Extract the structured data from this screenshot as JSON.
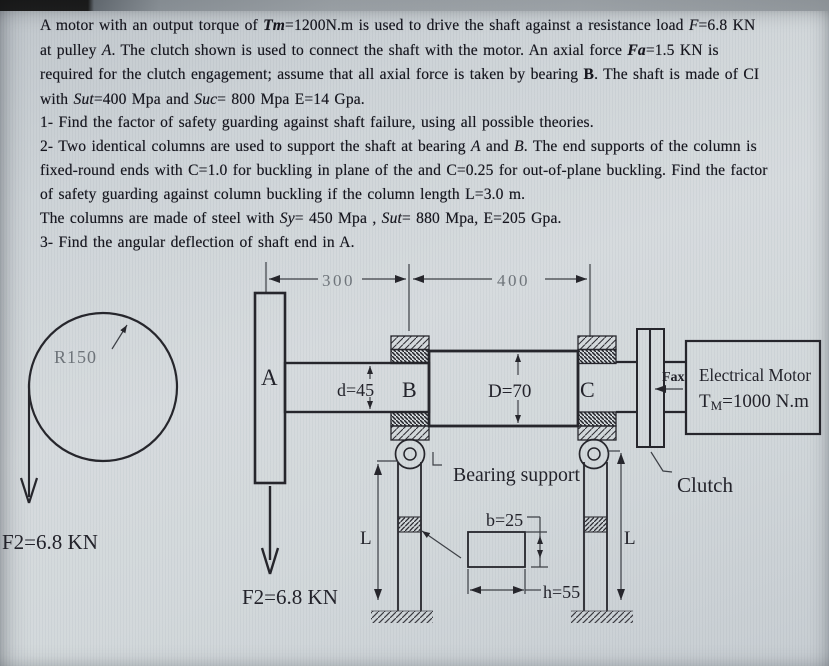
{
  "problem": {
    "para1": [
      "A motor with an output torque of <b><i>Tm</i></b>=1200N.m is used to drive the shaft against a resistance load <i>F</i>=6.8 KN",
      "at pulley <i>A</i>. The clutch shown is used to connect the shaft with the motor. An axial force <b><i>Fa</i></b>=1.5 KN is",
      "required for the clutch engagement; assume that all axial force is taken by bearing <b>B</b>. The shaft is made of CI",
      "with <i>Sut</i>=400 Mpa and <i>Suc</i>= 800 Mpa E=14 Gpa."
    ],
    "para2": [
      "1- Find the factor of safety guarding against shaft failure, using all possible theories.",
      "2- Two identical columns are used to support the shaft at bearing <i>A</i> and <i>B</i>. The end supports of the column is",
      "fixed-round ends with C=1.0 for buckling in plane of the and C=0.25 for out-of-plane buckling. Find the factor",
      "of safety guarding against column buckling if the column length L=3.0 m.",
      "The columns are made of steel with <i>Sy</i>= 450 Mpa , <i>Sut</i>= 880 Mpa, E=205 Gpa.",
      "3- Find the angular deflection of shaft end in A."
    ]
  },
  "figure": {
    "dim_300": "300",
    "dim_400": "400",
    "radius_label": "R150",
    "pulley_label": "A",
    "bearing_b_label": "B",
    "bearing_c_label": "C",
    "shaft_small_dim": "d=45",
    "shaft_large_dim": "D=70",
    "force_left": "F2=6.8 KN",
    "force_pulley": "F2=6.8 KN",
    "axial_force_label": "Fax",
    "motor_line1": "Electrical Motor",
    "motor_t": "T",
    "motor_t_sub": "M",
    "motor_t_rest": "=1000 N.m",
    "clutch_label": "Clutch",
    "bearing_support_label": "Bearing support",
    "column_length_left": "L",
    "column_length_right": "L",
    "section_b": "b=25",
    "section_h": "h=55"
  }
}
